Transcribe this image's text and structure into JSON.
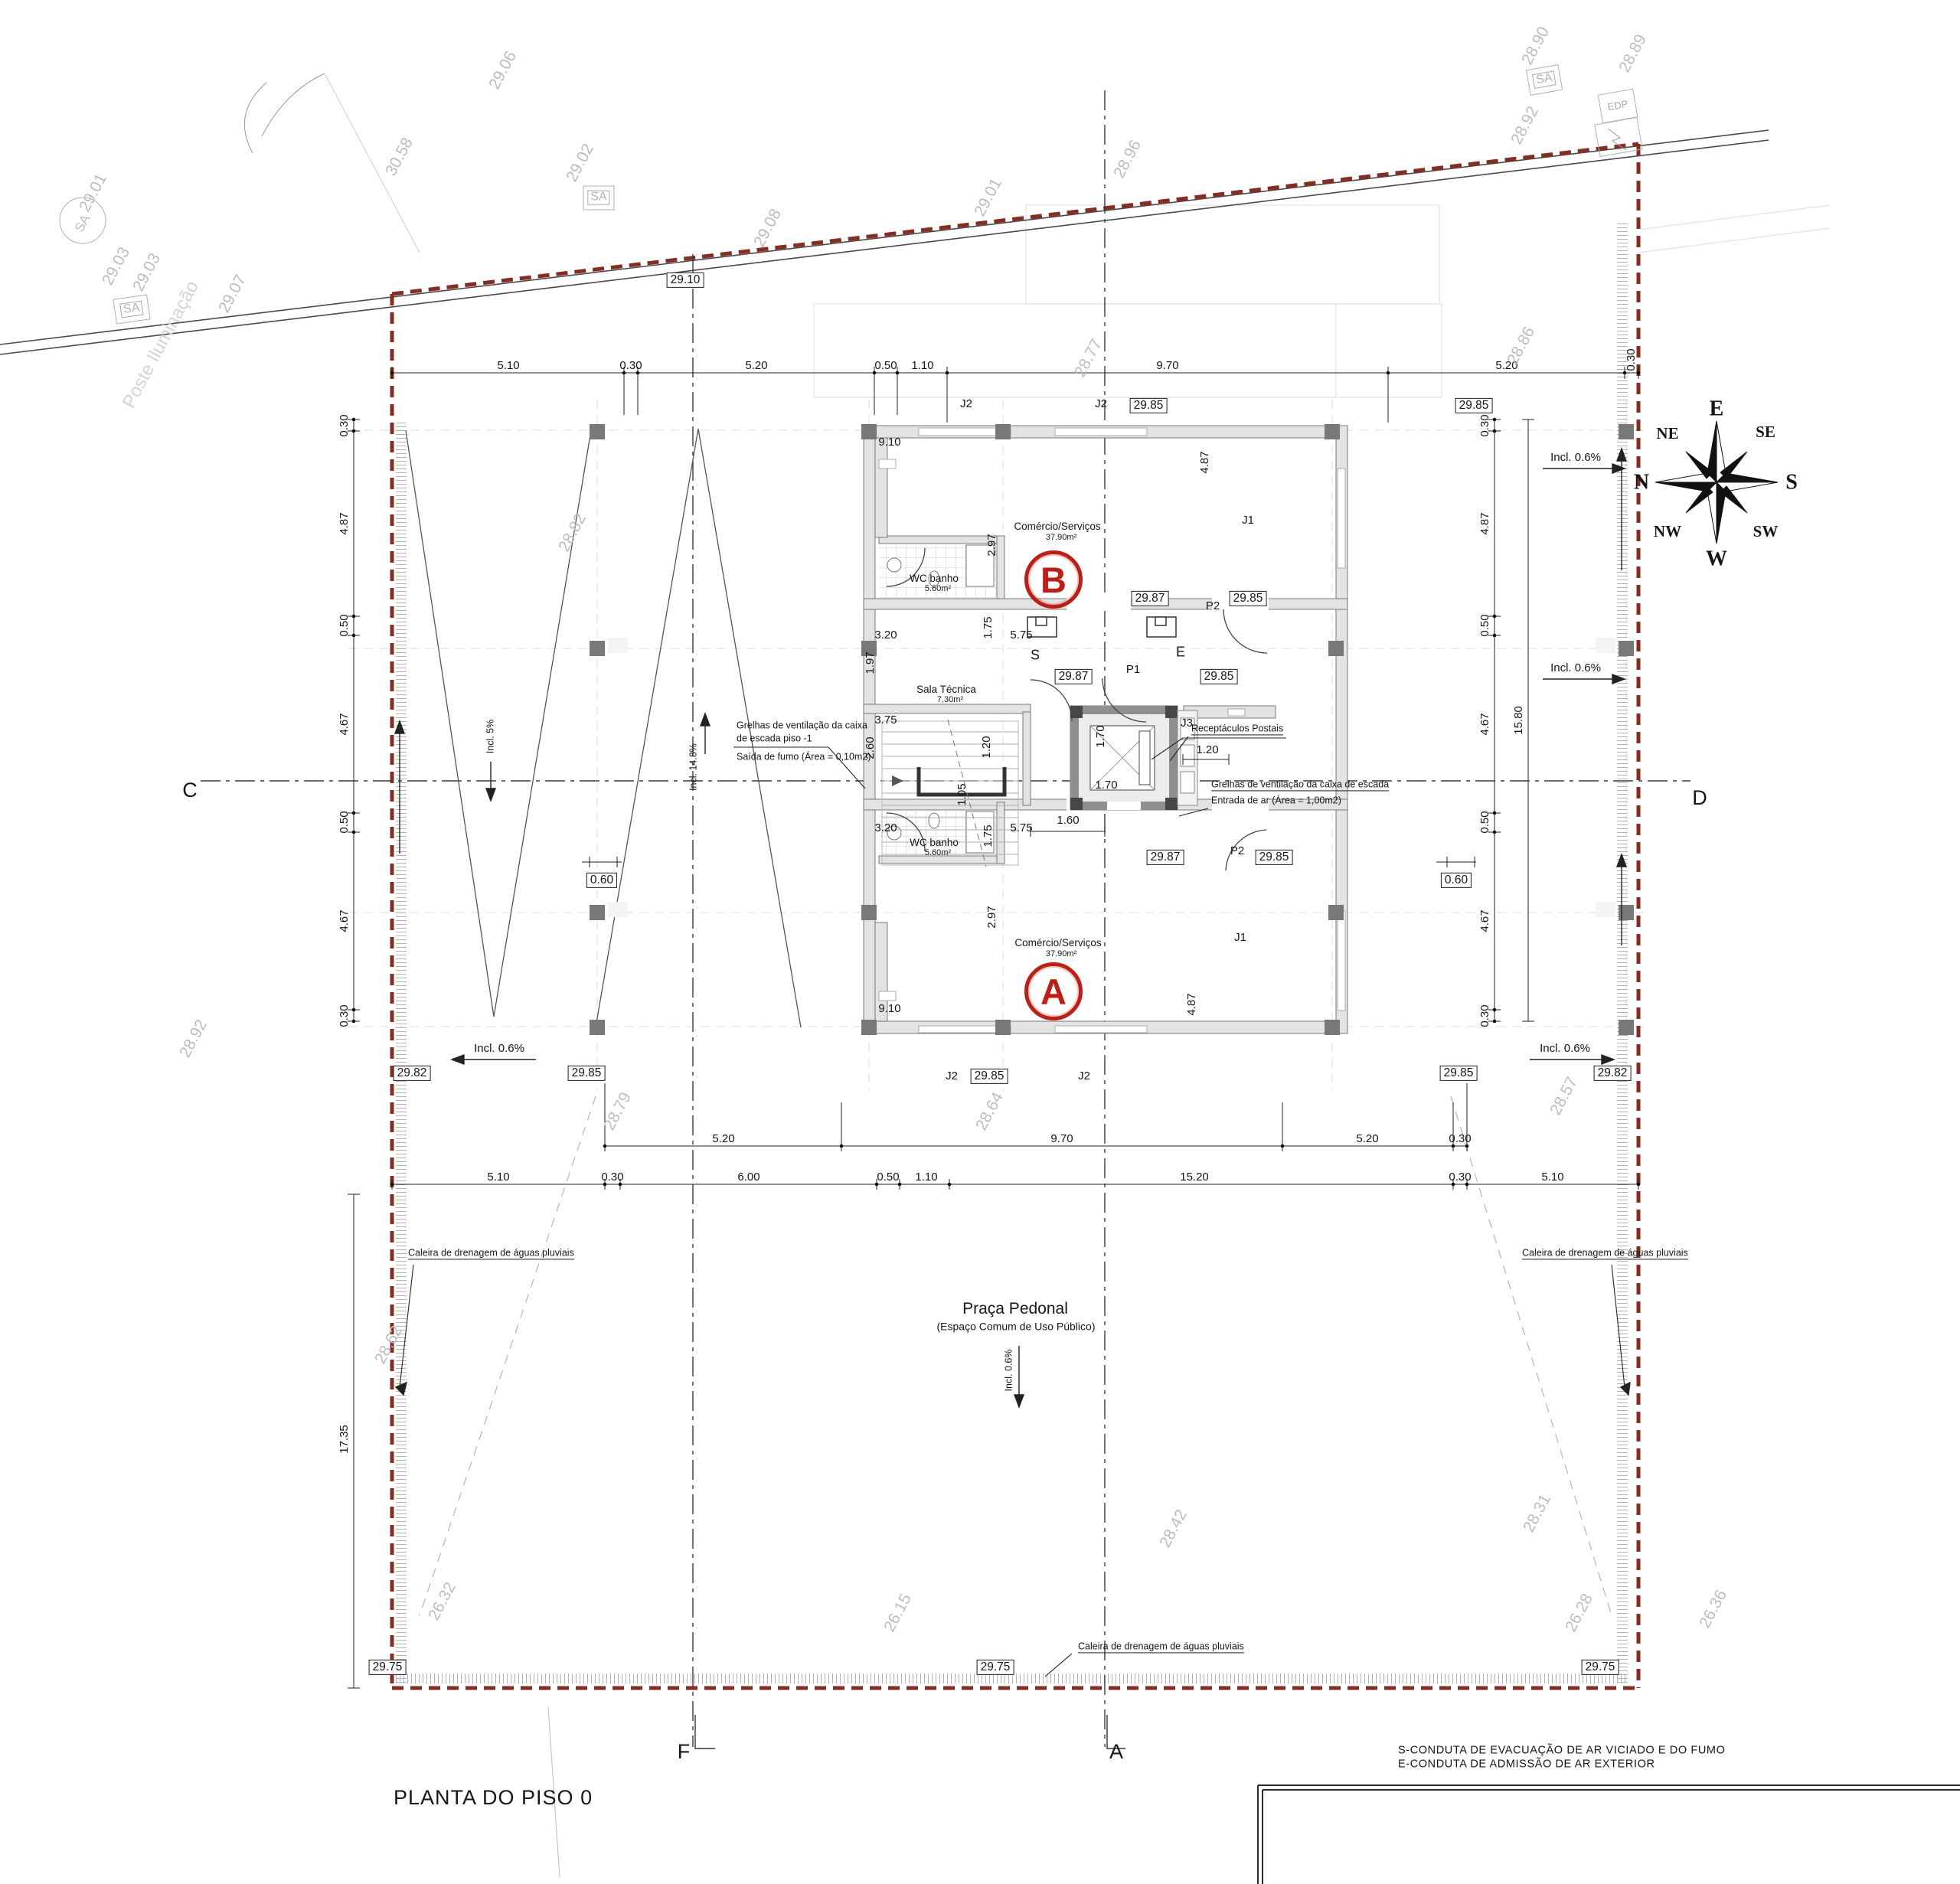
{
  "title": "PLANTA DO PISO 0",
  "legend": {
    "l1": "S-CONDUTA DE EVACUAÇÃO DE AR VICIADO E DO FUMO",
    "l2": "E-CONDUTA DE ADMISSÃO DE AR EXTERIOR"
  },
  "axes": {
    "c": "C",
    "d": "D",
    "f": "F",
    "a": "A"
  },
  "compass": {
    "e": "E",
    "s": "S",
    "w": "W",
    "n": "N",
    "ne": "NE",
    "se": "SE",
    "nw": "NW",
    "sw": "SW"
  },
  "rooms": {
    "unit_b": {
      "badge": "B",
      "name": "Comércio/Serviços",
      "area": "37.90m²"
    },
    "unit_a": {
      "badge": "A",
      "name": "Comércio/Serviços",
      "area": "37.90m²"
    },
    "wc_b": {
      "name": "WC banho",
      "area": "5.60m²"
    },
    "wc_a": {
      "name": "WC banho",
      "area": "5.60m²"
    },
    "sala": {
      "name": "Sala Técnica",
      "area": "7.30m²"
    }
  },
  "plaza": {
    "name": "Praça Pedonal",
    "subtitle": "(Espaço Comum de Uso Público)"
  },
  "notes": {
    "grelhas_piso": {
      "l1": "Grelhas de ventilação da caixa",
      "l2": "de escada piso  -1",
      "l3": "Saída de fumo (Área = 0,10m2)"
    },
    "postais": "Receptáculos Postais",
    "grelhas": {
      "l1": "Grelhas de ventilação da caixa de escada",
      "l2": "Entrada de ar (Área = 1,00m2)"
    },
    "caleira": "Caleira de drenagem de águas pluviais"
  },
  "slopes": {
    "i5": "Incl. 5%",
    "i148": "Incl. 14.8%",
    "i06": "Incl. 0.6%"
  },
  "ducts": {
    "s": "S",
    "e": "E"
  },
  "tags": {
    "j1": "J1",
    "j2": "J2",
    "j3": "J3",
    "p1": "P1",
    "p2": "P2"
  },
  "levels": [
    "29.10",
    "29.85",
    "29.85",
    "29.87",
    "29.85",
    "29.87",
    "29.85",
    "29.87",
    "29.85",
    "29.82",
    "29.85",
    "29.85",
    "29.85",
    "29.82",
    "29.75",
    "29.75",
    "29.75"
  ],
  "clear": {
    "c060": "0.60"
  },
  "dims": {
    "top": [
      "5.10",
      "0.30",
      "5.20",
      "0.50",
      "1.10",
      "9.70",
      "5.20",
      "0.30"
    ],
    "b1": [
      "5.20",
      "9.70",
      "5.20",
      "0.30"
    ],
    "b2": [
      "5.10",
      "0.30",
      "6.00",
      "0.50",
      "1.10",
      "15.20",
      "0.30",
      "5.10"
    ],
    "left": [
      "0.30",
      "4.87",
      "0.50",
      "4.67",
      "0.50",
      "4.67",
      "0.30",
      "17.35"
    ],
    "right": [
      "0.30",
      "4.87",
      "0.50",
      "4.67",
      "0.50",
      "4.67",
      "0.30",
      "15.80"
    ],
    "plan": [
      "9.10",
      "2.97",
      "3.20",
      "1.75",
      "5.75",
      "1.97",
      "3.75",
      "2.60",
      "1.20",
      "1.05",
      "1.60",
      "1.70",
      "1.70",
      "1.20",
      "4.87",
      "9.10",
      "2.97",
      "3.20",
      "1.75",
      "5.75",
      "4.87"
    ]
  },
  "survey": [
    "30.58",
    "29.06",
    "29.02",
    "29.01",
    "29.03",
    "29.03",
    "29.07",
    "29.08",
    "29.01",
    "28.96",
    "28.77",
    "28.90",
    "28.92",
    "28.89",
    "28.86",
    "28.82",
    "28.92",
    "28.79",
    "28.64",
    "28.57",
    "28.62",
    "26.32",
    "26.15",
    "28.42",
    "28.31",
    "26.28",
    "26.36"
  ],
  "ghost": "Poste Iluminação",
  "sa": "SA",
  "edp": "EDP",
  "colors": {
    "boundary": "#8a2b20",
    "badge": "#c21d15",
    "survey": "#bcbcbc"
  }
}
